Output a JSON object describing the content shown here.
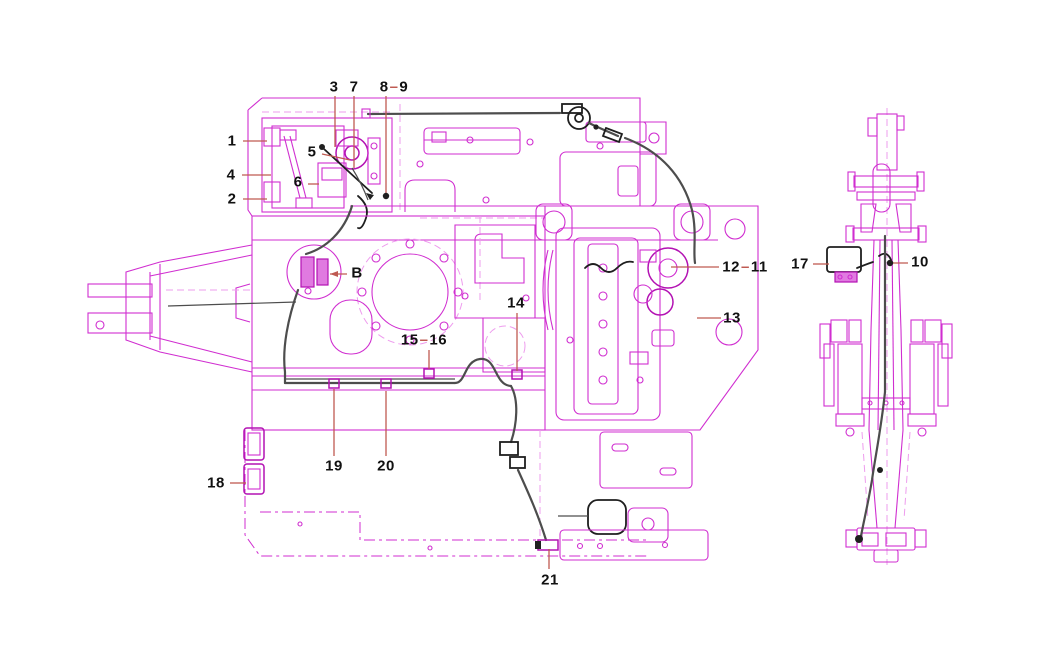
{
  "page": {
    "title": "Excavator wiring harness parts diagram",
    "description": "Line drawing: top view of excavator upper structure (left) and boom-arm assembly (right) with numbered part callouts",
    "background": "#ffffff"
  },
  "colors": {
    "magenta": "#d02ed0",
    "magenta_dark": "#b312b3",
    "pink_dashed": "#ee9cee",
    "cable_gray": "#4d4d4d",
    "cable_black": "#1f1f1f",
    "leader_red": "#bf5a52",
    "label_black": "#111111",
    "background": "#ffffff"
  },
  "diagram": {
    "views": [
      {
        "name": "main-body-top-view"
      },
      {
        "name": "boom-arm-top-view"
      }
    ],
    "labels": [
      {
        "id": "1",
        "text": "1",
        "x": 232,
        "y": 141,
        "leader": [
          [
            243,
            141
          ],
          [
            267,
            141
          ]
        ]
      },
      {
        "id": "4",
        "text": "4",
        "x": 231,
        "y": 175,
        "leader": [
          [
            242,
            175
          ],
          [
            271,
            175
          ]
        ]
      },
      {
        "id": "2",
        "text": "2",
        "x": 232,
        "y": 199,
        "leader": [
          [
            243,
            199
          ],
          [
            267,
            199
          ]
        ]
      },
      {
        "id": "3",
        "text": "3",
        "x": 334,
        "y": 87,
        "leader": [
          [
            335,
            96
          ],
          [
            335,
            147
          ]
        ]
      },
      {
        "id": "7",
        "text": "7",
        "x": 354,
        "y": 87,
        "leader": [
          [
            354,
            96
          ],
          [
            354,
            168
          ]
        ]
      },
      {
        "id": "8-9",
        "text": "8-9",
        "parts": [
          "8",
          "9"
        ],
        "separator": "–",
        "x": 394,
        "y": 87,
        "leader": [
          [
            386,
            96
          ],
          [
            386,
            196
          ]
        ],
        "dot": true
      },
      {
        "id": "5",
        "text": "5",
        "x": 312,
        "y": 152,
        "leader": [
          [
            322,
            154
          ],
          [
            350,
            160
          ]
        ]
      },
      {
        "id": "6",
        "text": "6",
        "x": 298,
        "y": 182,
        "leader": [
          [
            308,
            184
          ],
          [
            319,
            184
          ]
        ]
      },
      {
        "id": "B",
        "text": "B",
        "x": 357,
        "y": 273,
        "leader": [
          [
            347,
            274
          ],
          [
            330,
            274
          ]
        ],
        "arrow": true
      },
      {
        "id": "14",
        "text": "14",
        "x": 516,
        "y": 303,
        "leader": [
          [
            517,
            313
          ],
          [
            517,
            371
          ]
        ]
      },
      {
        "id": "15-16",
        "text": "15-16",
        "parts": [
          "15",
          "16"
        ],
        "separator": "–",
        "x": 424,
        "y": 340,
        "leader": [
          [
            429,
            350
          ],
          [
            429,
            369
          ]
        ]
      },
      {
        "id": "12-11",
        "text": "12-11",
        "parts": [
          "12",
          "11"
        ],
        "separator": "–",
        "x": 745,
        "y": 267,
        "leader": [
          [
            719,
            267
          ],
          [
            671,
            267
          ]
        ]
      },
      {
        "id": "13",
        "text": "13",
        "x": 732,
        "y": 318,
        "leader": [
          [
            721,
            318
          ],
          [
            697,
            318
          ]
        ]
      },
      {
        "id": "17",
        "text": "17",
        "x": 800,
        "y": 264,
        "leader": [
          [
            813,
            264
          ],
          [
            829,
            264
          ]
        ]
      },
      {
        "id": "10",
        "text": "10",
        "x": 920,
        "y": 262,
        "leader": [
          [
            908,
            263
          ],
          [
            890,
            263
          ]
        ],
        "dot": true
      },
      {
        "id": "19",
        "text": "19",
        "x": 334,
        "y": 466,
        "leader": [
          [
            334,
            456
          ],
          [
            334,
            389
          ]
        ]
      },
      {
        "id": "20",
        "text": "20",
        "x": 386,
        "y": 466,
        "leader": [
          [
            386,
            456
          ],
          [
            386,
            391
          ]
        ]
      },
      {
        "id": "18",
        "text": "18",
        "x": 216,
        "y": 483,
        "leader": [
          [
            230,
            483
          ],
          [
            246,
            483
          ]
        ]
      },
      {
        "id": "21",
        "text": "21",
        "x": 550,
        "y": 580,
        "leader": [
          [
            549,
            569
          ],
          [
            549,
            549
          ]
        ]
      }
    ]
  }
}
